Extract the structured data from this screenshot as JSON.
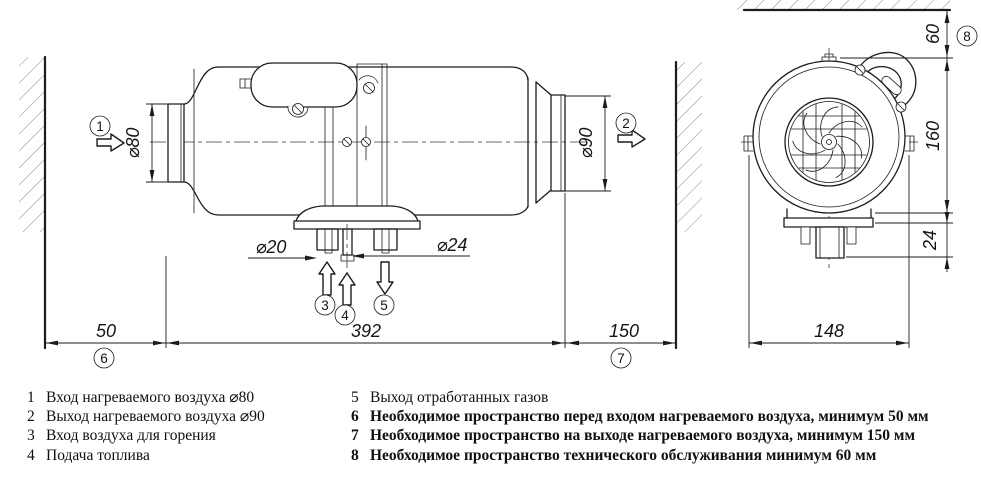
{
  "drawing": {
    "side": {
      "d80": "⌀80",
      "d90": "⌀90",
      "d20": "⌀20",
      "d24": "⌀24",
      "space_front": "50",
      "length": "392",
      "space_out": "150"
    },
    "front": {
      "space_top": "60",
      "height": "160",
      "depth": "24",
      "width": "148"
    },
    "callouts": {
      "c1": "1",
      "c2": "2",
      "c3": "3",
      "c4": "4",
      "c5": "5",
      "c6": "6",
      "c7": "7",
      "c8": "8"
    }
  },
  "legend": {
    "left": [
      {
        "num": "1",
        "text": "Вход нагреваемого воздуха ⌀80"
      },
      {
        "num": "2",
        "text": "Выход нагреваемого воздуха ⌀90"
      },
      {
        "num": "3",
        "text": "Вход воздуха для горения"
      },
      {
        "num": "4",
        "text": "Подача топлива"
      }
    ],
    "right": [
      {
        "num": "5",
        "text": "Выход отработанных газов"
      },
      {
        "num": "6",
        "text": "Необходимое пространство перед входом нагреваемого воздуха, минимум 50 мм"
      },
      {
        "num": "7",
        "text": "Необходимое пространство на выходе нагреваемого воздуха, минимум 150 мм"
      },
      {
        "num": "8",
        "text": "Необходимое пространство технического обслуживания минимум 60 мм"
      }
    ]
  }
}
